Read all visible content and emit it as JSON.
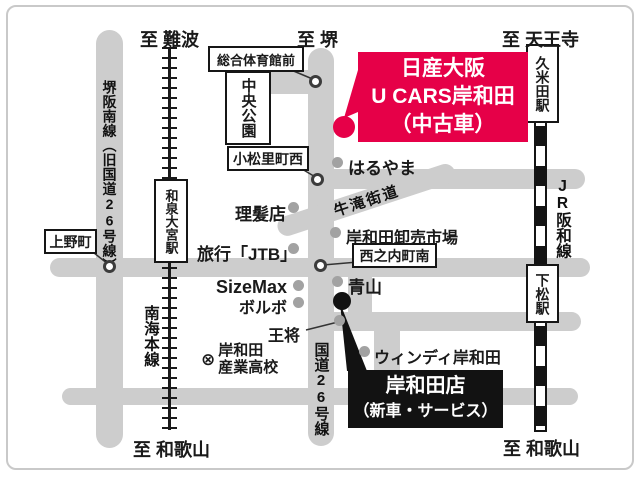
{
  "directions": {
    "top_left": "至 難波",
    "top_center": "至 堺",
    "top_right": "至 天王寺",
    "bottom_left": "至 和歌山",
    "bottom_right": "至 和歌山"
  },
  "roads": {
    "sakai_hannan_line": "堺阪南線（旧国道26号線）",
    "route_26": "国道26号線",
    "ushitaki_kaido": "牛滝街道"
  },
  "railways": {
    "nankai_main_line": "南海本線",
    "jr_hanwa_line": "JR阪和線"
  },
  "stations": {
    "izumi_omiya": "和泉大宮駅",
    "kumeda": "久米田駅",
    "shimomatsu": "下松駅"
  },
  "intersections": {
    "sogo_taiikukan_mae": "総合体育館前",
    "komatsuri_cho_nishi": "小松里町西",
    "ueno_cho": "上野町",
    "nishinouchi_cho_minami": "西之内町南"
  },
  "parks": {
    "chuo_koen": "中央公園"
  },
  "landmarks": {
    "haruyama": "はるやま",
    "barber": "理髪店",
    "jtb": "旅行「JTB」",
    "wholesale_market": "岸和田卸売市場",
    "sizemax": "SizeMax",
    "volvo": "ボルボ",
    "aoyama": "青山",
    "osho": "王将",
    "windy_kishiwada": "ウィンディ岸和田",
    "sangyo_high_school_line1": "岸和田",
    "sangyo_high_school_line2": "産業高校"
  },
  "school_symbol": "⊗",
  "stores": {
    "used_car": {
      "line1": "日産大阪",
      "line2": "U CARS岸和田",
      "line3": "（中古車）",
      "bg_color": "#e60048"
    },
    "new_car": {
      "line1": "岸和田店",
      "line2": "（新車・サービス）",
      "bg_color": "#121212"
    }
  },
  "colors": {
    "road": "#cdcdcd",
    "marker_gray": "#a2a2a2",
    "rail": "#141414",
    "accent_red": "#e60048"
  }
}
